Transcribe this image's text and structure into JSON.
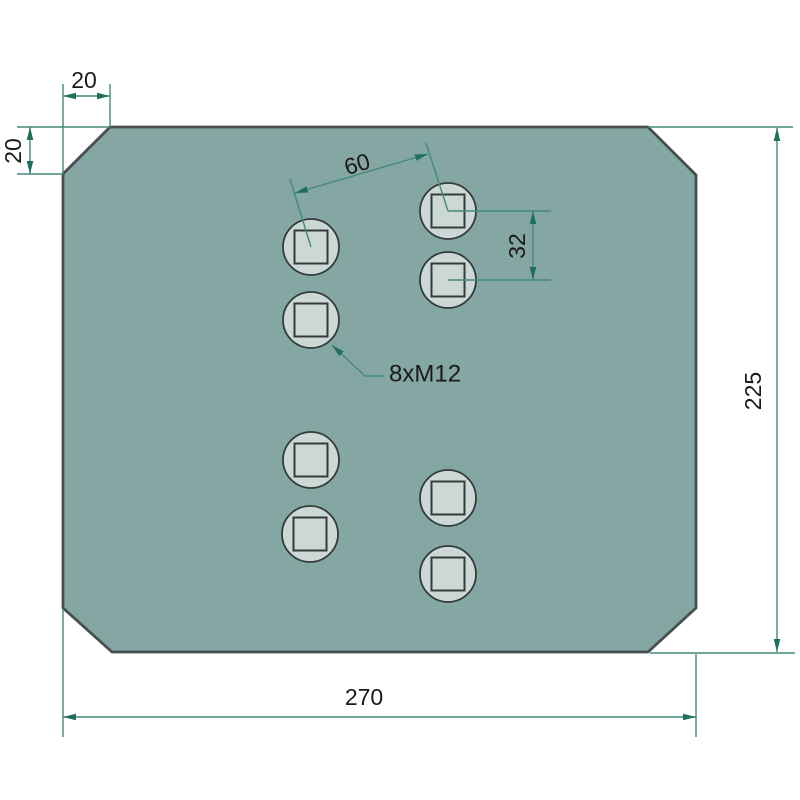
{
  "labels": {
    "chamfer_width": "20",
    "chamfer_height": "20",
    "hole_spacing_diagonal": "60",
    "hole_spacing_vertical": "32",
    "plate_height": "225",
    "plate_width": "270",
    "hole_callout": "8xM12"
  },
  "colors": {
    "background": "#ffffff",
    "plate_fill": "#85a7a3",
    "plate_stroke": "#47504f",
    "hole_fill": "#ccd8d4",
    "hole_stroke": "#333b3d",
    "dimension_line": "#45897b",
    "dimension_arrow": "#1f6e5e",
    "text": "#1a1a1a"
  },
  "geometry": {
    "hole_radius": 28,
    "hole_square_size": 33
  },
  "holes": [
    {
      "cx": 311,
      "cy": 247
    },
    {
      "cx": 448,
      "cy": 211
    },
    {
      "cx": 311,
      "cy": 320
    },
    {
      "cx": 448,
      "cy": 280
    },
    {
      "cx": 311,
      "cy": 460
    },
    {
      "cx": 448,
      "cy": 498
    },
    {
      "cx": 310,
      "cy": 534
    },
    {
      "cx": 448,
      "cy": 574
    }
  ]
}
